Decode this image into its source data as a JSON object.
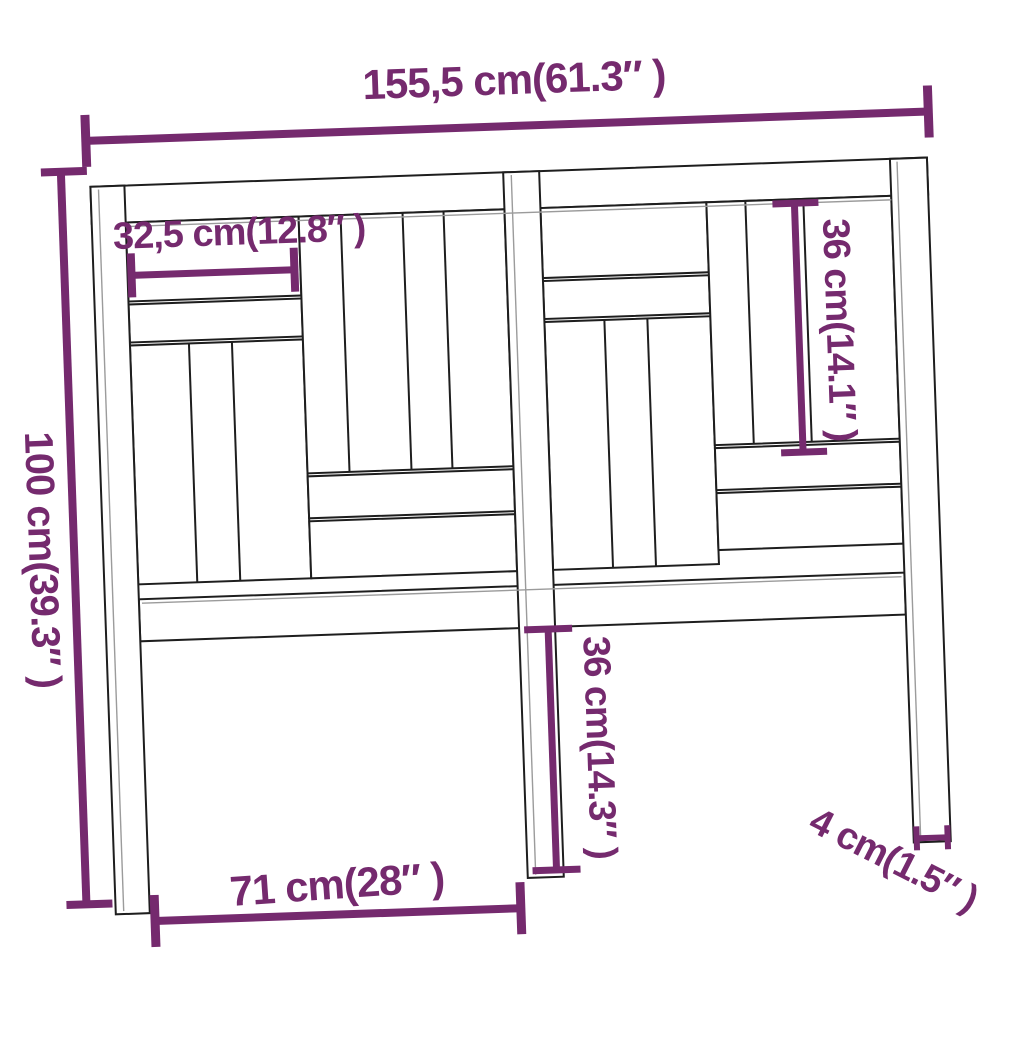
{
  "accent_color": "#752a6e",
  "outline_color": "#1e1e1e",
  "secondary_outline_color": "#9b9b9b",
  "background_color": "#ffffff",
  "dims": {
    "overall_width": "155,5 cm(61.3″ )",
    "overall_height": "100 cm(39.3″ )",
    "top_board_width": "32,5 cm(12.8″ )",
    "right_slat_height": "36 cm(14.1″ )",
    "center_leg_height": "36 cm(14.3″ )",
    "leg_span": "71 cm(28″ )",
    "leg_thickness": "4 cm(1.5″ )"
  }
}
